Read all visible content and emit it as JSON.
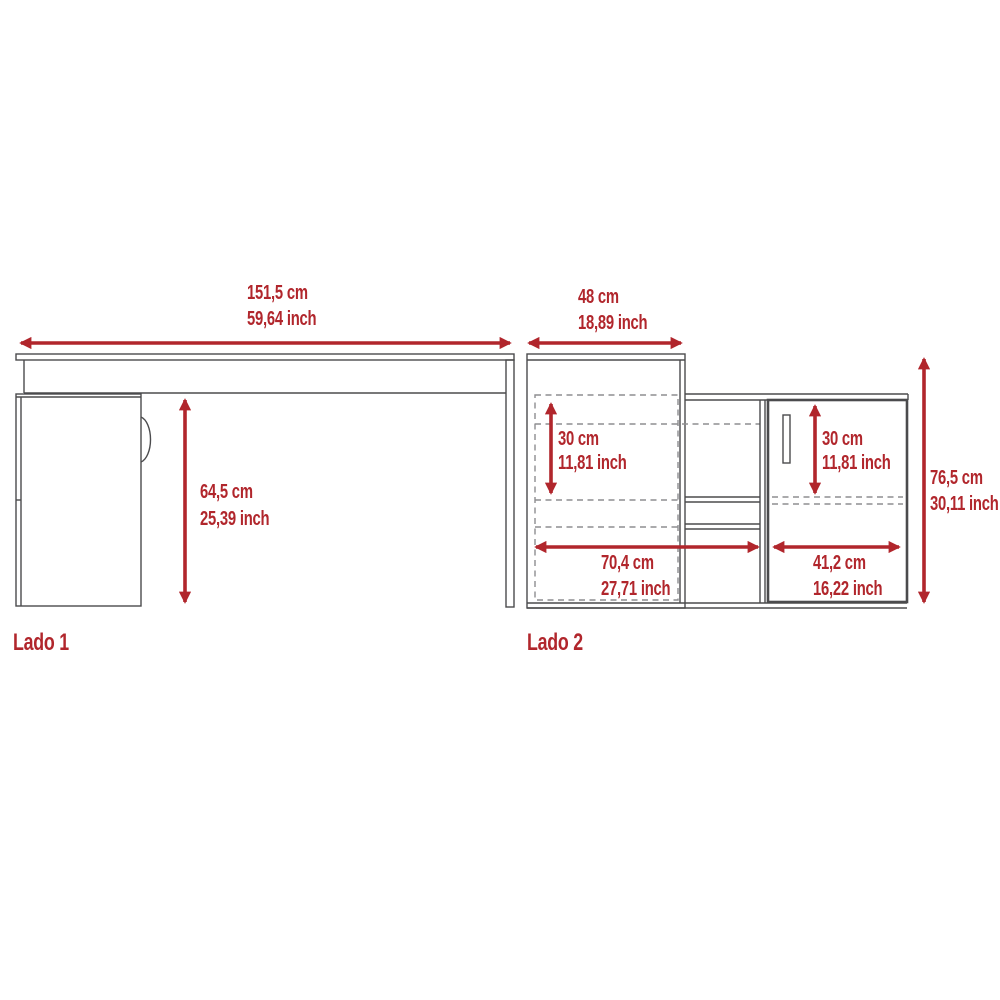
{
  "colors": {
    "accent_red": "#b1262c",
    "line_dark": "#4b4b4d",
    "line_gray": "#8d8d90",
    "background": "#ffffff"
  },
  "views": {
    "lado1": {
      "label": "Lado 1",
      "dimensions": {
        "width": {
          "cm": "151,5 cm",
          "inch": "59,64 inch"
        },
        "height": {
          "cm": "64,5 cm",
          "inch": "25,39 inch"
        }
      }
    },
    "lado2": {
      "label": "Lado 2",
      "dimensions": {
        "top_width": {
          "cm": "48 cm",
          "inch": "18,89 inch"
        },
        "left_clearance": {
          "cm": "30 cm",
          "inch": "11,81 inch"
        },
        "right_clearance": {
          "cm": "30 cm",
          "inch": "11,81 inch"
        },
        "bottom_left_width": {
          "cm": "70,4 cm",
          "inch": "27,71 inch"
        },
        "bottom_right_width": {
          "cm": "41,2 cm",
          "inch": "16,22 inch"
        },
        "total_height": {
          "cm": "76,5 cm",
          "inch": "30,11 inch"
        }
      }
    }
  }
}
